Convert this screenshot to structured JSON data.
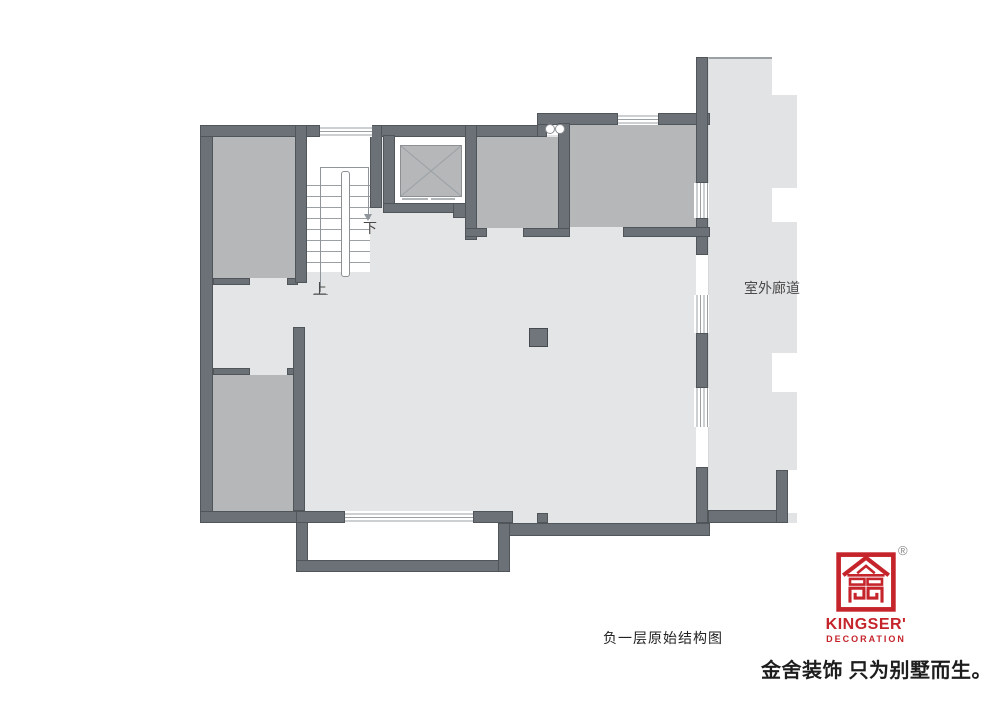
{
  "colors": {
    "wall": "#6b7176",
    "wall_edge": "#50555a",
    "room": "#b5b7b9",
    "floor": "#e4e5e6",
    "corridor": "#e2e3e4",
    "window_line": "#9aa0a4",
    "walkline": "#8f959a",
    "plan_text": "#4a4a4a",
    "brand_red": "#c5242b",
    "slogan_text": "#1d1d1d"
  },
  "plan": {
    "corridor_label": "室外廊道",
    "stair_down_label": "下",
    "stair_up_label": "上",
    "caption": "负一层原始结构图"
  },
  "branding": {
    "logo_title": "KINGSER'",
    "logo_subtitle": "DECORATION",
    "registered_mark": "®",
    "slogan": "金舍装饰 只为别墅而生。"
  }
}
